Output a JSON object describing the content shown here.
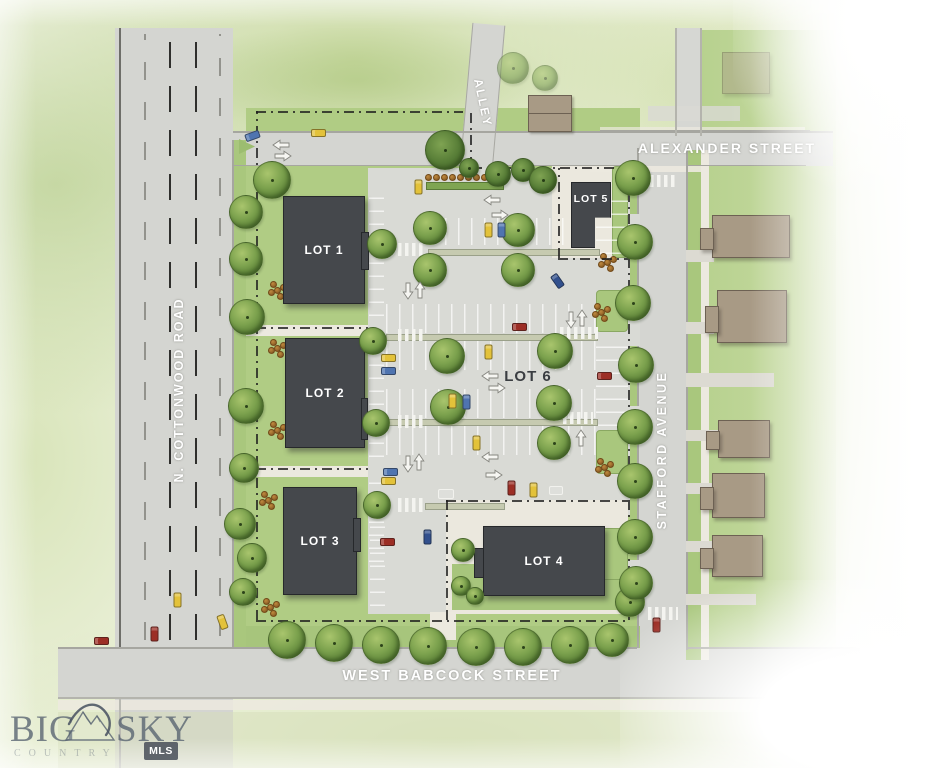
{
  "streets": {
    "cottonwood": "N. COTTONWOOD ROAD",
    "alexander": "ALEXANDER STREET",
    "stafford": "STAFFORD AVENUE",
    "babcock": "WEST BABCOCK STREET",
    "alley": "ALLEY"
  },
  "lots": [
    {
      "id": "lot-1",
      "label": "LOT 1"
    },
    {
      "id": "lot-2",
      "label": "LOT 2"
    },
    {
      "id": "lot-3",
      "label": "LOT 3"
    },
    {
      "id": "lot-4",
      "label": "LOT 4"
    },
    {
      "id": "lot-5",
      "label": "LOT 5"
    },
    {
      "id": "lot-6",
      "label": "LOT 6"
    }
  ],
  "watermark": {
    "brand_left": "BIG",
    "brand_right": "SKY",
    "subtitle": "COUNTRY",
    "badge": "MLS",
    "mountain_icon": "mountain-icon"
  },
  "legend_colors": {
    "road_gray": "#d4d5d1",
    "parking_gray": "#d9dad5",
    "lawn_green": "#abc97f",
    "tree_green": "#6f9a48",
    "building_dark_gray": "#45484c",
    "neighbor_building_tan": "#a89a85",
    "sidewalk_cream": "#ece9df",
    "car_yellow": "#e3c23a",
    "car_blue": "#4f74b0",
    "car_red": "#9c2e25",
    "street_label_white": "#ffffff",
    "boundary_black": "#1e1e1e"
  }
}
